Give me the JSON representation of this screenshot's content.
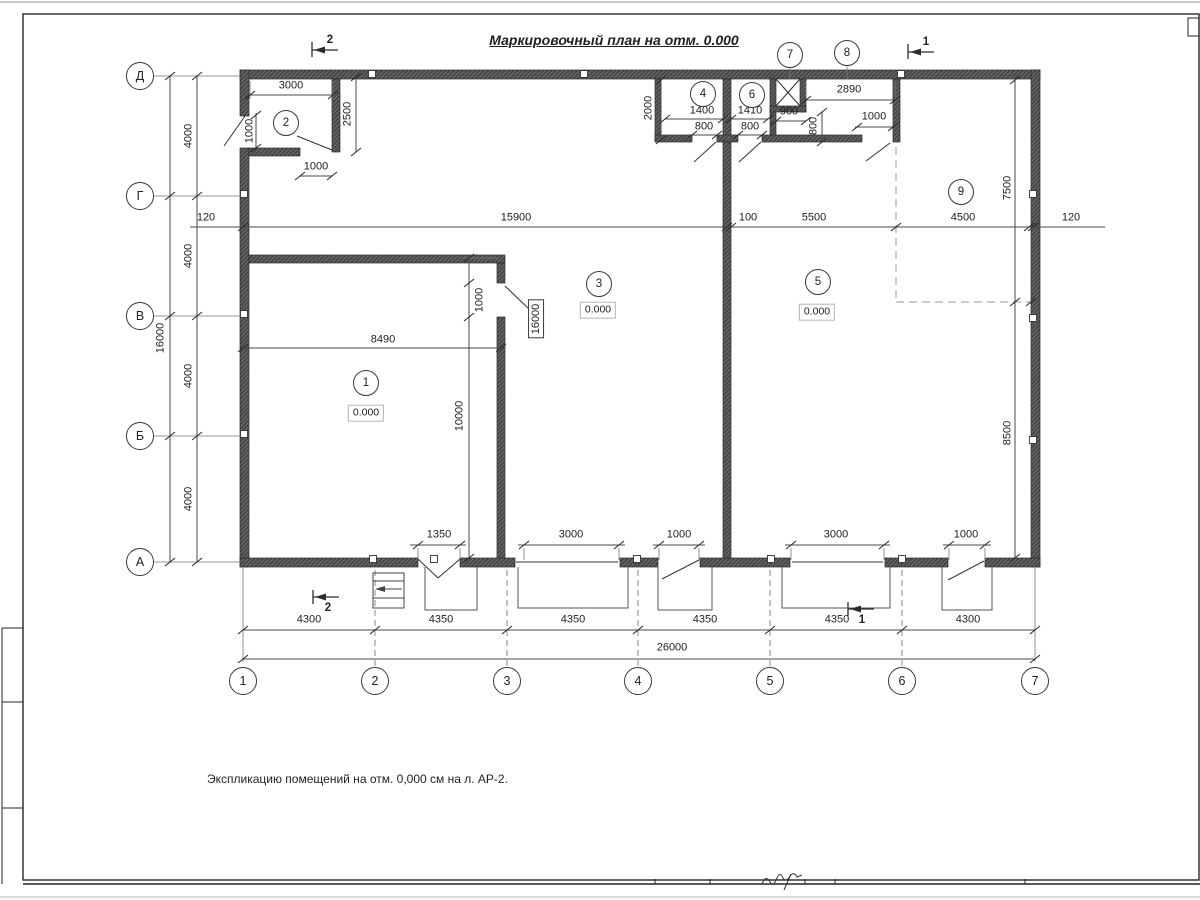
{
  "title": "Маркировочный план на отм. 0.000",
  "note": "Экспликацию помещений на отм. 0,000 см на л. АР-2.",
  "colors": {
    "wall": "#474747",
    "line": "#3a3a3a",
    "paper": "#ffffff"
  },
  "axis_left": [
    {
      "text": "Д",
      "x": 140,
      "y": 76
    },
    {
      "text": "Г",
      "x": 140,
      "y": 196
    },
    {
      "text": "В",
      "x": 140,
      "y": 316
    },
    {
      "text": "Б",
      "x": 140,
      "y": 436
    },
    {
      "text": "А",
      "x": 140,
      "y": 562
    }
  ],
  "axis_bottom": [
    {
      "text": "1",
      "x": 243,
      "y": 681
    },
    {
      "text": "2",
      "x": 375,
      "y": 681
    },
    {
      "text": "3",
      "x": 507,
      "y": 681
    },
    {
      "text": "4",
      "x": 638,
      "y": 681
    },
    {
      "text": "5",
      "x": 770,
      "y": 681
    },
    {
      "text": "6",
      "x": 902,
      "y": 681
    },
    {
      "text": "7",
      "x": 1035,
      "y": 681
    }
  ],
  "room_numbers": [
    {
      "text": "1",
      "x": 366,
      "y": 383
    },
    {
      "text": "2",
      "x": 286,
      "y": 123
    },
    {
      "text": "3",
      "x": 599,
      "y": 284
    },
    {
      "text": "4",
      "x": 703,
      "y": 94
    },
    {
      "text": "5",
      "x": 818,
      "y": 282
    },
    {
      "text": "6",
      "x": 752,
      "y": 95
    },
    {
      "text": "7",
      "x": 790,
      "y": 55
    },
    {
      "text": "8",
      "x": 847,
      "y": 53
    },
    {
      "text": "9",
      "x": 961,
      "y": 192
    }
  ],
  "elevations": [
    {
      "text": "0.000",
      "x": 366,
      "y": 413
    },
    {
      "text": "0.000",
      "x": 598,
      "y": 310
    },
    {
      "text": "0.000",
      "x": 817,
      "y": 312
    }
  ],
  "boxed_labels": [
    {
      "text": "16000",
      "x": 536,
      "y": 319
    }
  ],
  "section_marks": [
    {
      "text": "2",
      "x": 330,
      "y": 40
    },
    {
      "text": "1",
      "x": 926,
      "y": 42
    },
    {
      "text": "2",
      "x": 328,
      "y": 608
    },
    {
      "text": "1",
      "x": 862,
      "y": 620
    }
  ],
  "dim_labels": [
    {
      "text": "3000",
      "x": 291,
      "y": 86
    },
    {
      "text": "2500",
      "x": 348,
      "y": 114,
      "rot": 1
    },
    {
      "text": "1000",
      "x": 250,
      "y": 131,
      "rot": 1
    },
    {
      "text": "1000",
      "x": 316,
      "y": 167
    },
    {
      "text": "4000",
      "x": 189,
      "y": 136,
      "rot": 1
    },
    {
      "text": "4000",
      "x": 189,
      "y": 256,
      "rot": 1
    },
    {
      "text": "4000",
      "x": 189,
      "y": 376,
      "rot": 1
    },
    {
      "text": "4000",
      "x": 189,
      "y": 499,
      "rot": 1
    },
    {
      "text": "16000",
      "x": 161,
      "y": 338,
      "rot": 1
    },
    {
      "text": "120",
      "x": 206,
      "y": 218
    },
    {
      "text": "15900",
      "x": 516,
      "y": 218
    },
    {
      "text": "100",
      "x": 748,
      "y": 218
    },
    {
      "text": "5500",
      "x": 814,
      "y": 218
    },
    {
      "text": "4500",
      "x": 963,
      "y": 218
    },
    {
      "text": "120",
      "x": 1071,
      "y": 218
    },
    {
      "text": "2000",
      "x": 649,
      "y": 108,
      "rot": 1
    },
    {
      "text": "1400",
      "x": 702,
      "y": 111
    },
    {
      "text": "800",
      "x": 704,
      "y": 127
    },
    {
      "text": "1410",
      "x": 750,
      "y": 111
    },
    {
      "text": "800",
      "x": 750,
      "y": 127
    },
    {
      "text": "900",
      "x": 789,
      "y": 112
    },
    {
      "text": "800",
      "x": 814,
      "y": 126,
      "rot": 1
    },
    {
      "text": "2890",
      "x": 849,
      "y": 90
    },
    {
      "text": "1000",
      "x": 874,
      "y": 117
    },
    {
      "text": "8490",
      "x": 383,
      "y": 340
    },
    {
      "text": "1000",
      "x": 480,
      "y": 300,
      "rot": 1
    },
    {
      "text": "10000",
      "x": 460,
      "y": 416,
      "rot": 1
    },
    {
      "text": "7500",
      "x": 1008,
      "y": 188,
      "rot": 1
    },
    {
      "text": "8500",
      "x": 1008,
      "y": 433,
      "rot": 1
    },
    {
      "text": "1350",
      "x": 439,
      "y": 535
    },
    {
      "text": "3000",
      "x": 571,
      "y": 535
    },
    {
      "text": "1000",
      "x": 679,
      "y": 535
    },
    {
      "text": "3000",
      "x": 836,
      "y": 535
    },
    {
      "text": "1000",
      "x": 966,
      "y": 535
    },
    {
      "text": "4300",
      "x": 309,
      "y": 620
    },
    {
      "text": "4350",
      "x": 441,
      "y": 620
    },
    {
      "text": "4350",
      "x": 573,
      "y": 620
    },
    {
      "text": "4350",
      "x": 705,
      "y": 620
    },
    {
      "text": "4350",
      "x": 837,
      "y": 620
    },
    {
      "text": "4300",
      "x": 968,
      "y": 620
    },
    {
      "text": "26000",
      "x": 672,
      "y": 648
    }
  ]
}
